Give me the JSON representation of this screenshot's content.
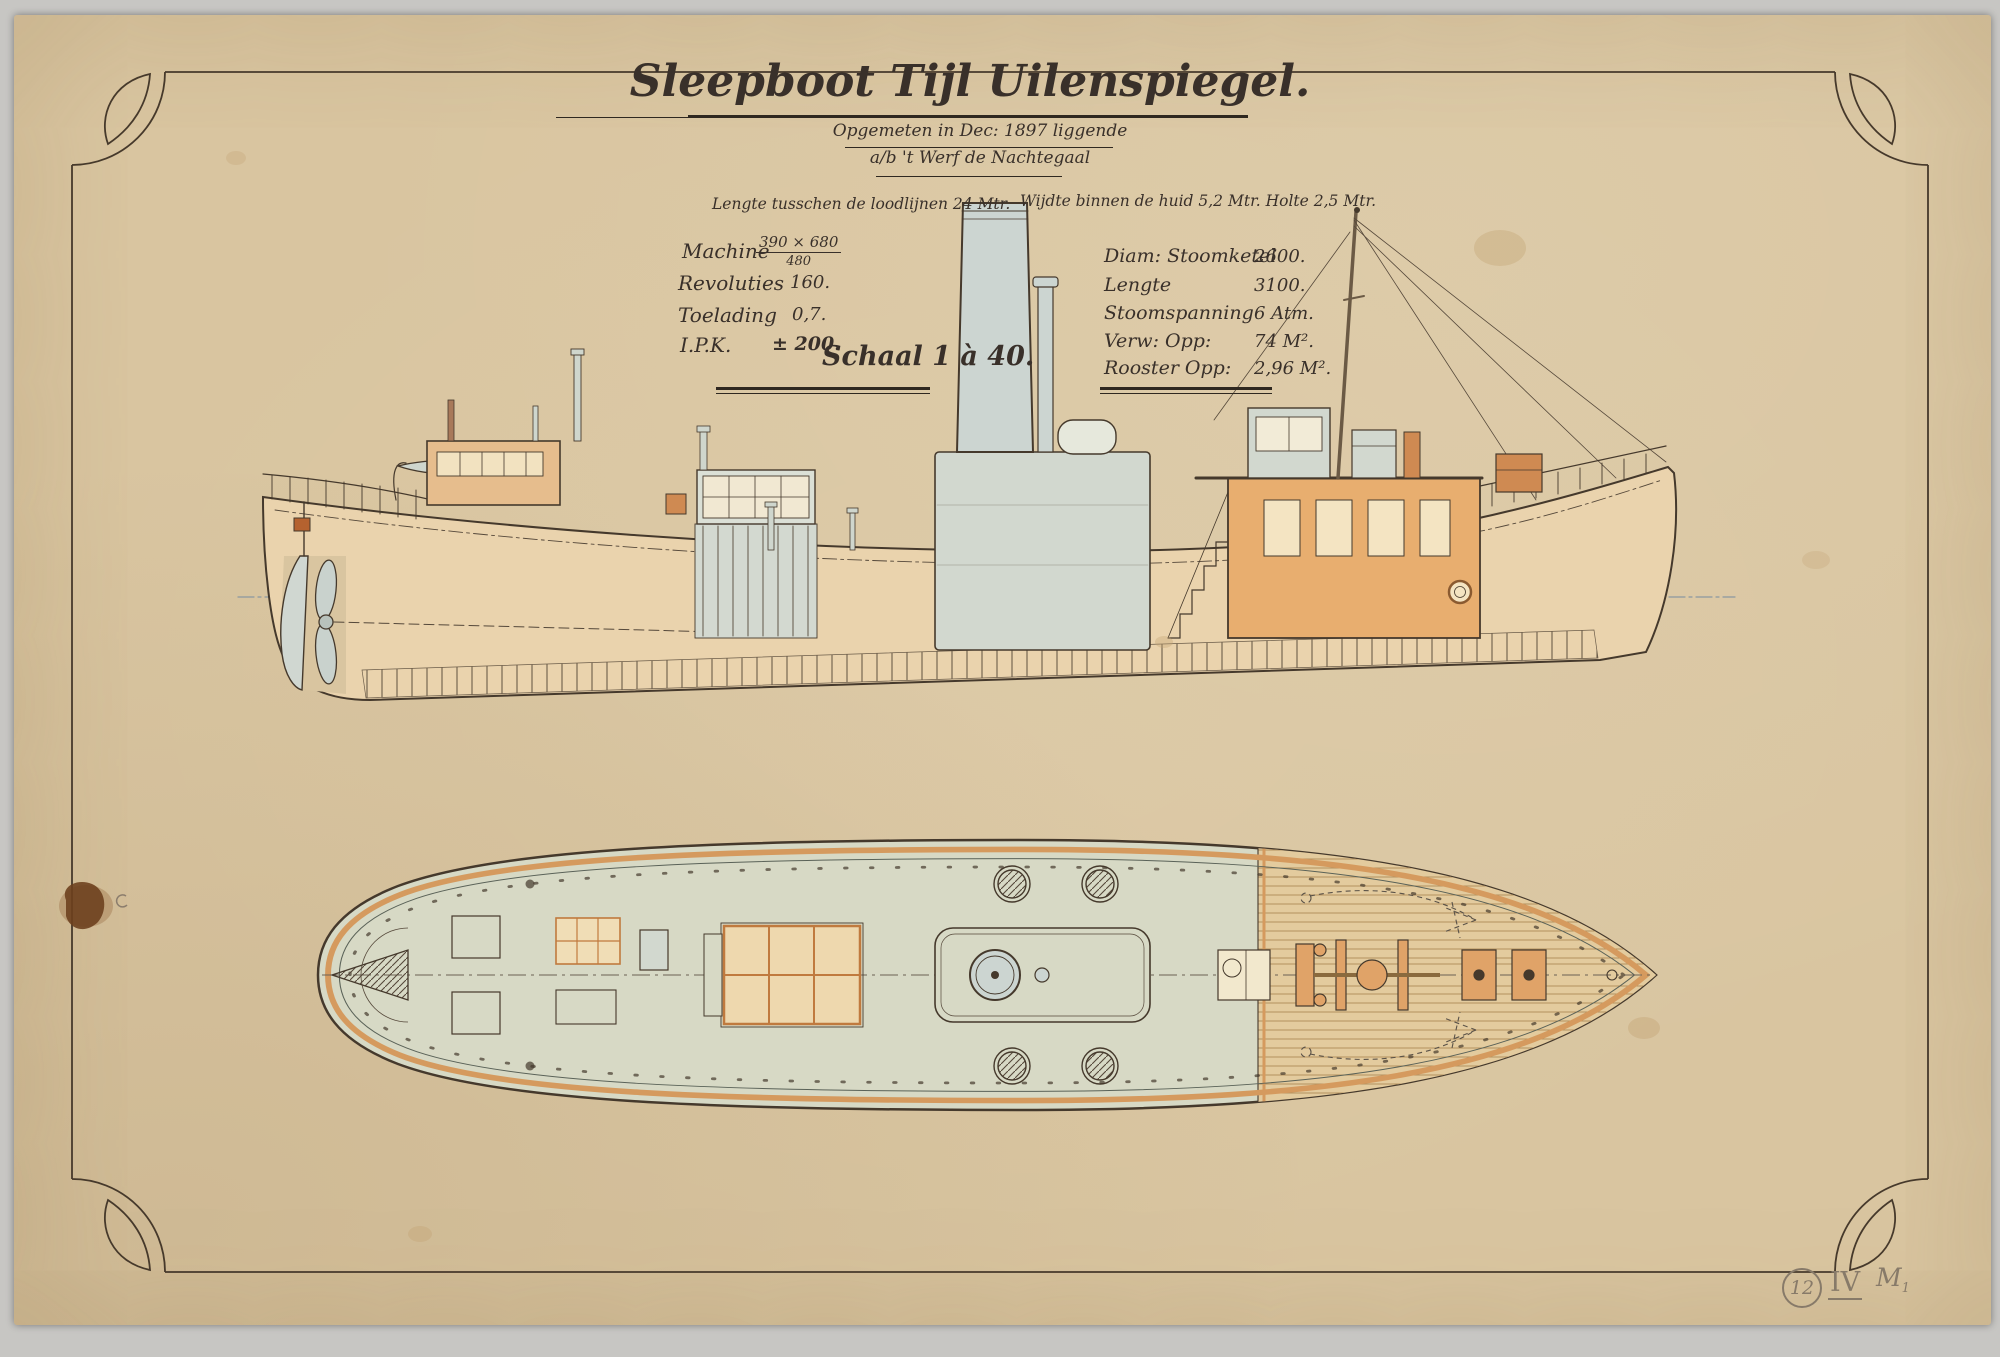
{
  "sheet": {
    "title": "Sleepboot Tijl Uilenspiegel.",
    "subtitle_line1": "Opgemeten in Dec: 1897 liggende",
    "subtitle_line2": "a/b 't Werf de Nachtegaal",
    "scale_label": "Schaal 1 à 40.",
    "principal_dimensions": {
      "length_note": "Lengte tusschen de loodlijnen 24 Mtr.",
      "beam_depth_note": "Wijdte binnen de huid 5,2 Mtr.  Holte 2,5 Mtr."
    },
    "machine_specs": {
      "rows": [
        {
          "label": "Machine",
          "numerator": "390 × 680",
          "denominator": "480"
        },
        {
          "label": "Revoluties",
          "value": "160."
        },
        {
          "label": "Toelading",
          "value": "0,7."
        },
        {
          "label": "I.P.K.",
          "value": "± 200."
        }
      ]
    },
    "boiler_specs": {
      "rows": [
        {
          "label": "Diam: Stoomketel",
          "value": "2600."
        },
        {
          "label": "Lengte",
          "value": "3100."
        },
        {
          "label": "Stoomspanning",
          "value": "6 Atm."
        },
        {
          "label": "Verw: Opp:",
          "value": "74 M²."
        },
        {
          "label": "Rooster Opp:",
          "value": "2,96 M²."
        }
      ]
    },
    "pencil_annotations": {
      "sheet_number": "12",
      "roman_numeral": "IV",
      "mark": "M",
      "mark_subscript": "1"
    }
  },
  "colors": {
    "paper": "#d9c5a0",
    "backdrop": "#c7c6c3",
    "ink": "#39302a",
    "wash_blue_grey": "#cdd5ce",
    "wash_hull_tan": "#ead3ad",
    "wash_deck_green": "#d7d9c5",
    "wash_plank_tan": "#e3cb9e",
    "wash_orange": "#e8ae6f",
    "accent_orange": "#d59a5e",
    "pencil": "#877a69"
  }
}
